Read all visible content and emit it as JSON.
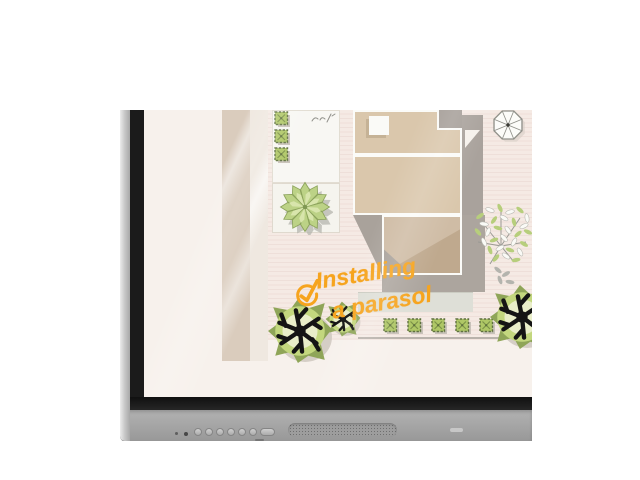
{
  "scene": {
    "description": "Cropped corner product view of an interactive flat-panel touchscreen displaying a top-down garden landscaping plan with a handwritten task annotation",
    "background_color": "#FFFFFF"
  },
  "annotation": {
    "line1": "Installing",
    "line2": "a parasol",
    "color": "#F6A41E",
    "icon": "check-circle-icon"
  },
  "plan": {
    "elements": [
      "house-roof-plan",
      "skylight",
      "parasol-top-view",
      "star-plant-on-patio",
      "tree-foliage",
      "round-bush-large",
      "round-bush-small",
      "round-bush-right",
      "box-hedge-row",
      "box-hedge-column",
      "wooden-deck-band",
      "terrace-panel",
      "garden-path-line",
      "handwritten-scribble"
    ],
    "hedge_row_count": 5,
    "hedge_column_count": 3,
    "colors": {
      "roof_tan": "#DAC7AC",
      "roof_dark_tan": "#CFBCA5",
      "roof_shadow_gray": "#A9A29C",
      "deck_stripe_pink": "#F5EAE4",
      "deck_band_tan": "#DACCBD",
      "panel_cream": "#F8F7F3",
      "plant_green": "#BCD286",
      "bush_green": "#C3D77E",
      "hedge_green": "#AFC766",
      "branch_black": "#141414",
      "screen_base": "#F7F1EC"
    }
  },
  "device": {
    "type": "interactive flat panel display",
    "edge_color": "#C9C9C9",
    "frame_color": "#1B1B1B",
    "bezel_color": "#A4A4A4",
    "indicator_dots": 2,
    "buttons": [
      "control-button-1",
      "control-button-2",
      "control-button-3",
      "control-button-4",
      "control-button-5",
      "control-button-6",
      "control-button-wide"
    ],
    "speaker": "speaker-grille",
    "logo": "brand-logo-plate"
  }
}
